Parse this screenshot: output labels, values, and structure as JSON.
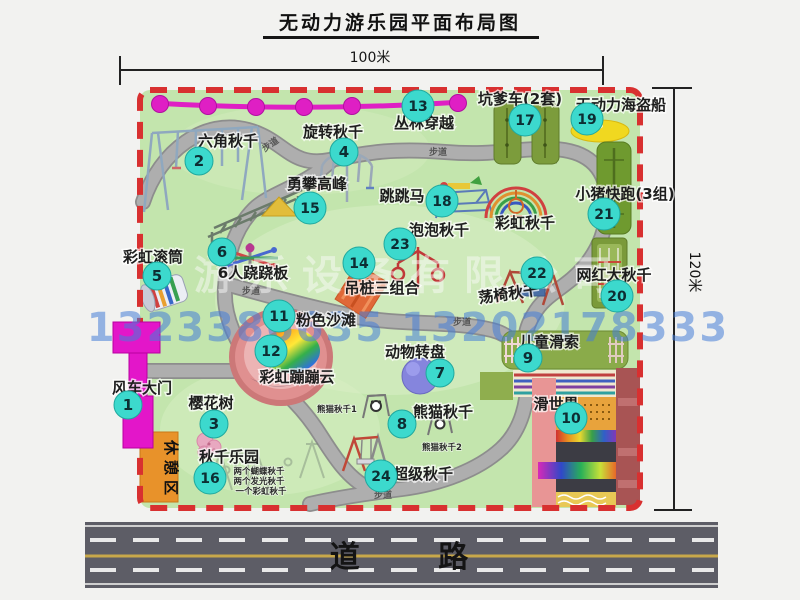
{
  "title": "无动力游乐园平面布局图",
  "dimensions": {
    "width": "100米",
    "height": "120米"
  },
  "road": {
    "label": "道 路"
  },
  "watermark": {
    "company": "游乐设备有限公司",
    "phones": "1323386635 13202178333"
  },
  "map": {
    "rest_area": "休憩区",
    "path_label": "步道",
    "rainbow_swing": "彩虹秋千",
    "panda_swing_1": "熊猫秋千1",
    "panda_swing_2": "熊猫秋千2",
    "swing_notes": [
      "两个蝴蝶秋千",
      "两个发光秋千",
      "一个彩虹秋千"
    ]
  },
  "colors": {
    "map_green": "#c3e5ad",
    "border_red": "#d83030",
    "badge_teal": "#3cd9cd",
    "zipline_magenta": "#df1fc4",
    "road_gray": "#5d5d66"
  },
  "items": [
    {
      "num": "1",
      "label": "风车大门"
    },
    {
      "num": "2",
      "label": "六角秋千"
    },
    {
      "num": "3",
      "label": "樱花树"
    },
    {
      "num": "4",
      "label": "旋转秋千"
    },
    {
      "num": "5",
      "label": "彩虹滚筒"
    },
    {
      "num": "6",
      "label": "6人跷跷板"
    },
    {
      "num": "7",
      "label": "动物转盘"
    },
    {
      "num": "8",
      "label": "熊猫秋千"
    },
    {
      "num": "9",
      "label": "儿童滑索"
    },
    {
      "num": "10",
      "label": "滑世界"
    },
    {
      "num": "11",
      "label": "粉色沙滩"
    },
    {
      "num": "12",
      "label": "彩虹蹦蹦云"
    },
    {
      "num": "13",
      "label": "丛林穿越"
    },
    {
      "num": "14",
      "label": "吊桩三组合"
    },
    {
      "num": "15",
      "label": "勇攀高峰"
    },
    {
      "num": "16",
      "label": "秋千乐园"
    },
    {
      "num": "17",
      "label": "坑爹车(2套)"
    },
    {
      "num": "18",
      "label": "跳跳马"
    },
    {
      "num": "19",
      "label": "无动力海盗船"
    },
    {
      "num": "20",
      "label": "网红大秋千"
    },
    {
      "num": "21",
      "label": "小猪快跑(3组)"
    },
    {
      "num": "22",
      "label": "荡椅秋千"
    },
    {
      "num": "23",
      "label": "泡泡秋千"
    },
    {
      "num": "24",
      "label": "超级秋千"
    }
  ]
}
